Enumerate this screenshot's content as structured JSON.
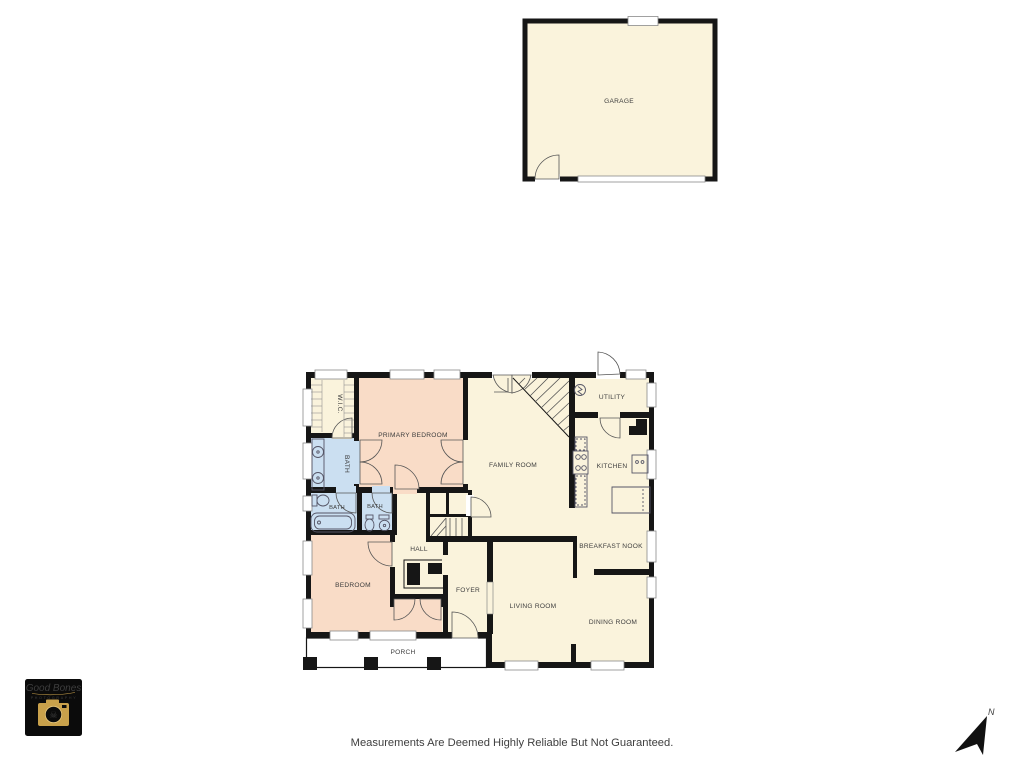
{
  "colors": {
    "background": "#ffffff",
    "walls": "#161616",
    "floor_cream": "#FAF3DC",
    "floor_pink": "#F9DCC7",
    "floor_blue": "#CBDFF1",
    "logo_gold": "#C9A14B",
    "label_text": "#3E3E3E"
  },
  "rooms": {
    "garage": "GARAGE",
    "wic": "W.I.C.",
    "primary_bedroom": "PRIMARY BEDROOM",
    "family_room": "FAMILY ROOM",
    "utility": "UTILITY",
    "kitchen": "KITCHEN",
    "bath_primary": "BATH",
    "bath_hall": "BATH",
    "bath_second": "BATH",
    "hall": "HALL",
    "bedroom": "BEDROOM",
    "foyer": "FOYER",
    "living_room": "LIVING ROOM",
    "breakfast_nook": "BREAKFAST NOOK",
    "dining_room": "DINING ROOM",
    "porch": "PORCH"
  },
  "footer": {
    "disclaimer": "Measurements Are Deemed Highly Reliable But Not Guaranteed."
  },
  "compass": {
    "north_label": "N"
  },
  "logo": {
    "brand": "Good Bones",
    "subtitle": "PHOTOGRAPHY",
    "skull_glyph": "☠"
  }
}
